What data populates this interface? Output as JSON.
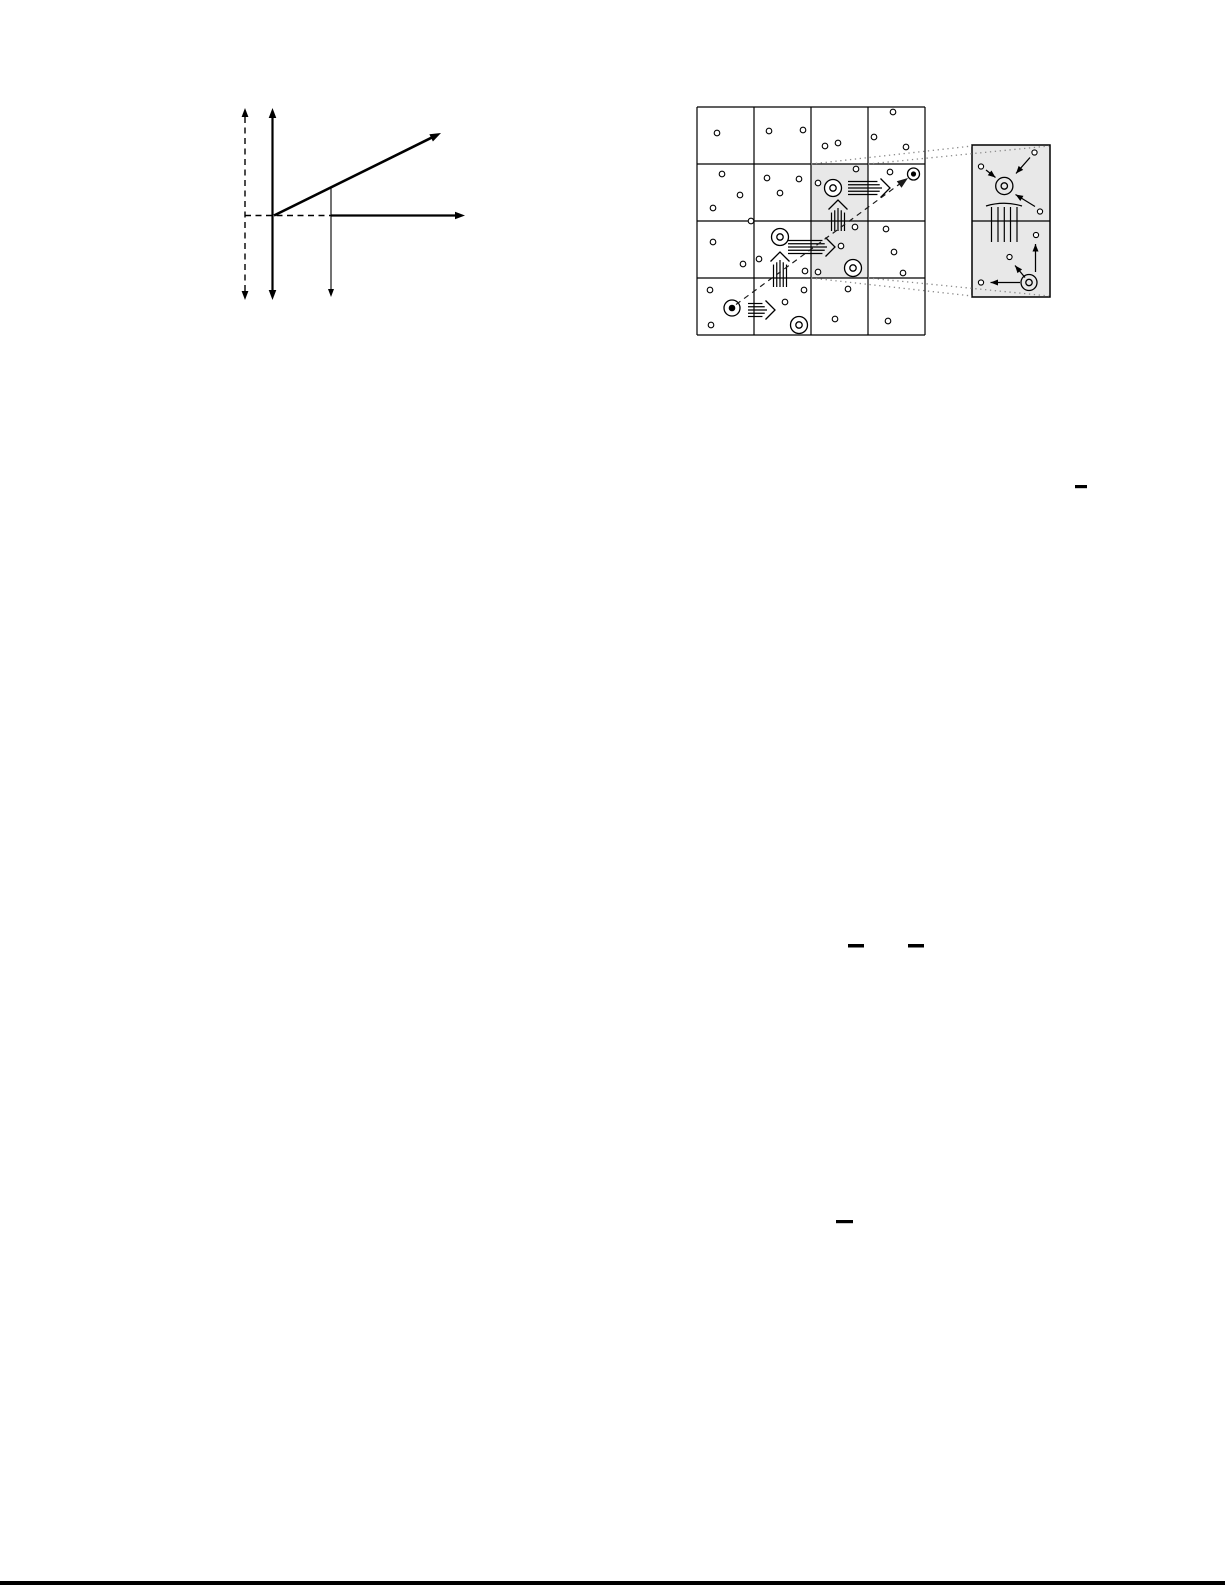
{
  "page": {
    "width": 1225,
    "height": 1585,
    "background": "#ffffff",
    "ink": "#000000",
    "trajectory_color": "#1a1a1a",
    "shade_color": "#e8e8e8",
    "dot_color": "#8a8a8a",
    "bottom_rule": {
      "x": 0,
      "y": 1581,
      "w": 1225,
      "h": 4
    }
  },
  "axes_figure": {
    "dashed_vertical_axis": {
      "x": 245,
      "y1": 108,
      "y2": 300,
      "width": 1.4,
      "dash": "6 4.5"
    },
    "solid_vertical_axis": {
      "x": 272.5,
      "y1": 108,
      "y2": 300,
      "width": 2.2
    },
    "origin": {
      "x": 274,
      "y": 215.5
    },
    "ray": {
      "x2": 441,
      "y2": 133,
      "width": 2.6
    },
    "dashed_baseline": {
      "x1": 245,
      "x2": 331,
      "y": 215.5,
      "width": 1.4,
      "dash": "6 4.5"
    },
    "horizontal_axis": {
      "x1": 331,
      "x2": 465,
      "y": 215.5,
      "width": 2.2
    },
    "drop_arrow": {
      "x": 331,
      "y1": 188,
      "y2": 297,
      "width": 1.1
    }
  },
  "grid_figure": {
    "x": 697,
    "y": 107,
    "cols": 4,
    "rows": 4,
    "cell_w": 57,
    "cell_h": 57,
    "line_width": 1.2,
    "shaded_cells": [
      [
        2,
        1
      ],
      [
        2,
        2
      ]
    ],
    "grains": [
      [
        717,
        133
      ],
      [
        769,
        131
      ],
      [
        803,
        130
      ],
      [
        825,
        146
      ],
      [
        838,
        143
      ],
      [
        874,
        137
      ],
      [
        893,
        112
      ],
      [
        906,
        147
      ],
      [
        722,
        174
      ],
      [
        740,
        195
      ],
      [
        713,
        208
      ],
      [
        767,
        178
      ],
      [
        799,
        179
      ],
      [
        780,
        193
      ],
      [
        818,
        183
      ],
      [
        856,
        169
      ],
      [
        890,
        172
      ],
      [
        751,
        221
      ],
      [
        713,
        242
      ],
      [
        743,
        264
      ],
      [
        759,
        259
      ],
      [
        805,
        271
      ],
      [
        841,
        246
      ],
      [
        855,
        227
      ],
      [
        818,
        272
      ],
      [
        886,
        229
      ],
      [
        894,
        252
      ],
      [
        903,
        273
      ],
      [
        710,
        290
      ],
      [
        711,
        325
      ],
      [
        785,
        302
      ],
      [
        804,
        290
      ],
      [
        848,
        289
      ],
      [
        835,
        319
      ],
      [
        888,
        321
      ]
    ],
    "grain_radius": 2.8,
    "double_circles": [
      [
        833,
        188
      ],
      [
        780,
        237
      ],
      [
        853,
        268
      ],
      [
        799,
        325
      ]
    ],
    "double_circle_r": 8.5,
    "double_circle_inner_r": 3.2,
    "target_circles": [
      {
        "x": 732,
        "y": 308,
        "r": 8,
        "dot": 3.3
      },
      {
        "x": 913.5,
        "y": 174,
        "r": 6,
        "dot": 2.6
      }
    ],
    "hatched_arrows": [
      {
        "dir": "right",
        "tip_x": 890,
        "tip_y": 188,
        "len": 42
      },
      {
        "dir": "up",
        "tip_x": 838,
        "tip_y": 200,
        "len": 31
      },
      {
        "dir": "right",
        "tip_x": 835,
        "tip_y": 247,
        "len": 47
      },
      {
        "dir": "up",
        "tip_x": 780,
        "tip_y": 252,
        "len": 35
      },
      {
        "dir": "right",
        "tip_x": 775,
        "tip_y": 310,
        "len": 27
      }
    ],
    "trajectory": {
      "x1": 736,
      "y1": 304.5,
      "x2": 901,
      "y2": 183,
      "tip_x": 908,
      "tip_y": 178,
      "dash": "5.5 4.5"
    },
    "connectors": [
      [
        811,
        164,
        972,
        146
      ],
      [
        868,
        164,
        1049,
        146
      ],
      [
        811,
        278,
        972,
        296
      ],
      [
        868,
        278,
        1049,
        296
      ]
    ],
    "connector_dash": "1.3 3.6"
  },
  "inset_figure": {
    "x": 972,
    "y": 145,
    "w": 78,
    "h": 152,
    "divider_y": 221,
    "border_width": 1.5,
    "grain_radius": 2.6,
    "top_cell": {
      "center_symbol": {
        "x": 1004.3,
        "y": 186,
        "r": 8.6,
        "inner_r": 3.2
      },
      "grains": [
        [
          1034.5,
          152.5
        ],
        [
          981,
          166.5
        ],
        [
          1040,
          211.5
        ]
      ],
      "arrows": [
        [
          1030,
          157.5,
          1016,
          173.5
        ],
        [
          986,
          170,
          995.5,
          177.5
        ],
        [
          1035,
          206.5,
          1015.5,
          194.5
        ]
      ],
      "fan": {
        "x1": 986,
        "x2": 1022,
        "arc_y": 206,
        "apex_y": 200.5,
        "lines_x": [
          991.5,
          998,
          1004.3,
          1010.5,
          1017
        ],
        "lines_y1": 207,
        "lines_y2": 242
      }
    },
    "bottom_cell": {
      "corner_symbol": {
        "x": 1029,
        "y": 282.5,
        "r": 8,
        "inner_r": 3.2
      },
      "grains": [
        [
          1036,
          235
        ],
        [
          1009.5,
          257
        ],
        [
          981,
          282.5
        ]
      ],
      "arrows": [
        [
          1035.5,
          272,
          1035.5,
          244
        ],
        [
          1025,
          277.5,
          1015,
          265.5
        ],
        [
          1020,
          282.5,
          990.5,
          282.5
        ]
      ]
    }
  },
  "fraction_bars": [
    [
      1075,
      485,
      12,
      3.2
    ],
    [
      848,
      944,
      16,
      3.5
    ],
    [
      908,
      944,
      16,
      3.5
    ],
    [
      836,
      1220,
      17,
      3.2
    ]
  ]
}
